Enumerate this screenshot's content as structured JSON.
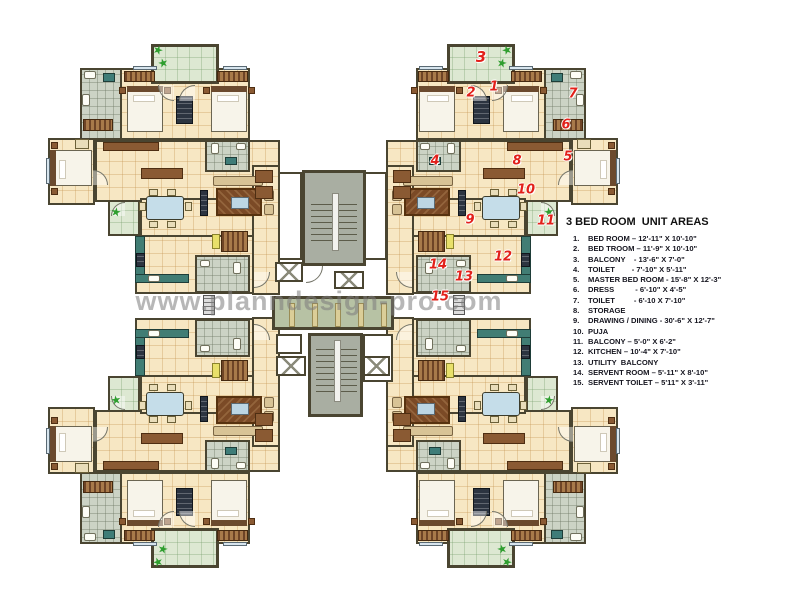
{
  "page": {
    "watermark": "www.planndesign-pro.com"
  },
  "legend": {
    "title": "3 BED ROOM  UNIT AREAS",
    "items": [
      {
        "num": "1.",
        "text": "BED ROOM – 12'-11\" X 10'-10\""
      },
      {
        "num": "2.",
        "text": "BED TROOM – 11'-9\" X 10'-10\""
      },
      {
        "num": "3.",
        "text": "BALCONY    - 13'-6\" X 7'-0\""
      },
      {
        "num": "4.",
        "text": "TOILET        - 7'-10\" X 5'-11\""
      },
      {
        "num": "5.",
        "text": "MASTER BED ROOM - 15'-8\" X 12'-3\""
      },
      {
        "num": "6.",
        "text": "DRESS          - 6'-10\" X 4'-5\""
      },
      {
        "num": "7.",
        "text": "TOILET         - 6'-10 X 7'-10\""
      },
      {
        "num": "8.",
        "text": "STORAGE"
      },
      {
        "num": "9.",
        "text": "DRAWING / DINING - 30'-6\" X 12'-7\""
      },
      {
        "num": "10.",
        "text": "PUJA"
      },
      {
        "num": "11.",
        "text": "BALCONY – 5'-0\" X 6'-2\""
      },
      {
        "num": "12.",
        "text": "KITCHEN – 10'-4\" X 7'-10\""
      },
      {
        "num": "13.",
        "text": "UTILITY  BALCONY"
      },
      {
        "num": "14.",
        "text": "SERVENT ROOM – 5'-11\" X 8'-10\""
      },
      {
        "num": "15.",
        "text": "SERVENT TOILET – 5'11\" X 3'-11\""
      }
    ]
  },
  "markers": [
    {
      "label": "1",
      "x": 494,
      "y": 87
    },
    {
      "label": "2",
      "x": 471,
      "y": 93
    },
    {
      "label": "3",
      "x": 481,
      "y": 57,
      "size": 15
    },
    {
      "label": "4",
      "x": 435,
      "y": 161
    },
    {
      "label": "5",
      "x": 568,
      "y": 157
    },
    {
      "label": "6",
      "x": 566,
      "y": 125
    },
    {
      "label": "7",
      "x": 573,
      "y": 94
    },
    {
      "label": "8",
      "x": 517,
      "y": 161
    },
    {
      "label": "9",
      "x": 470,
      "y": 220
    },
    {
      "label": "10",
      "x": 526,
      "y": 190
    },
    {
      "label": "11",
      "x": 546,
      "y": 221
    },
    {
      "label": "12",
      "x": 503,
      "y": 257
    },
    {
      "label": "13",
      "x": 464,
      "y": 277
    },
    {
      "label": "14",
      "x": 438,
      "y": 265
    },
    {
      "label": "15",
      "x": 440,
      "y": 297
    }
  ],
  "decorations": {
    "star_glyph": "★",
    "stars": [
      {
        "x": 158,
        "y": 50,
        "r": 20
      },
      {
        "x": 163,
        "y": 63,
        "r": -15
      },
      {
        "x": 507,
        "y": 50,
        "r": -20
      },
      {
        "x": 502,
        "y": 63,
        "r": 15
      },
      {
        "x": 116,
        "y": 212,
        "r": 10
      },
      {
        "x": 549,
        "y": 212,
        "r": -10
      },
      {
        "x": 158,
        "y": 562,
        "r": -20
      },
      {
        "x": 163,
        "y": 549,
        "r": 15
      },
      {
        "x": 507,
        "y": 562,
        "r": 20
      },
      {
        "x": 502,
        "y": 549,
        "r": -15
      },
      {
        "x": 116,
        "y": 400,
        "r": -10
      },
      {
        "x": 549,
        "y": 400,
        "r": 10
      }
    ]
  },
  "palette": {
    "wall": "#4a4531",
    "floor": "#f7e7c3",
    "balcony": "#dde8d2",
    "tile": "#ccd3c5",
    "corridor": "#b7c2a4",
    "stair": "#a9aea2",
    "teal": "#417d74",
    "wood": "#8a5a33",
    "rug": "#7b4a26",
    "sofa": "#d8c396",
    "table": "#c5dde9",
    "marker": "#e2201a",
    "star": "#2f9e2f",
    "watermark": "#7d7d7d",
    "legendText": "#15151f"
  }
}
